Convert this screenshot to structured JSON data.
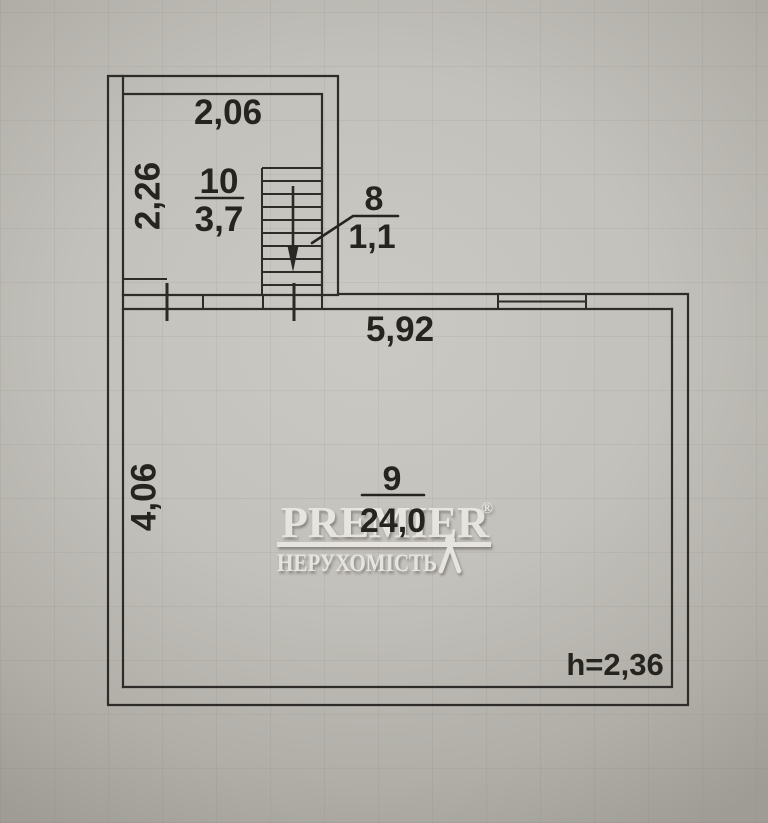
{
  "plan": {
    "labels": {
      "room10_number": "10",
      "room10_area": "3,7",
      "room8_number": "8",
      "room8_area": "1,1",
      "room9_number": "9",
      "room9_area": "24,0",
      "dim_upper_width": "2,06",
      "dim_upper_depth": "2,26",
      "dim_main_width": "5,92",
      "dim_main_depth": "4,06",
      "ceiling_height": "h=2,36"
    },
    "colors": {
      "ink": "#26241f",
      "wall": "#2e2c29",
      "paper": "#c5c3bd"
    }
  },
  "watermark": {
    "brand": "PREMIER",
    "registered_mark": "®",
    "subtitle": "НЕРУХОМІСТЬ",
    "color": "#edebe6"
  }
}
